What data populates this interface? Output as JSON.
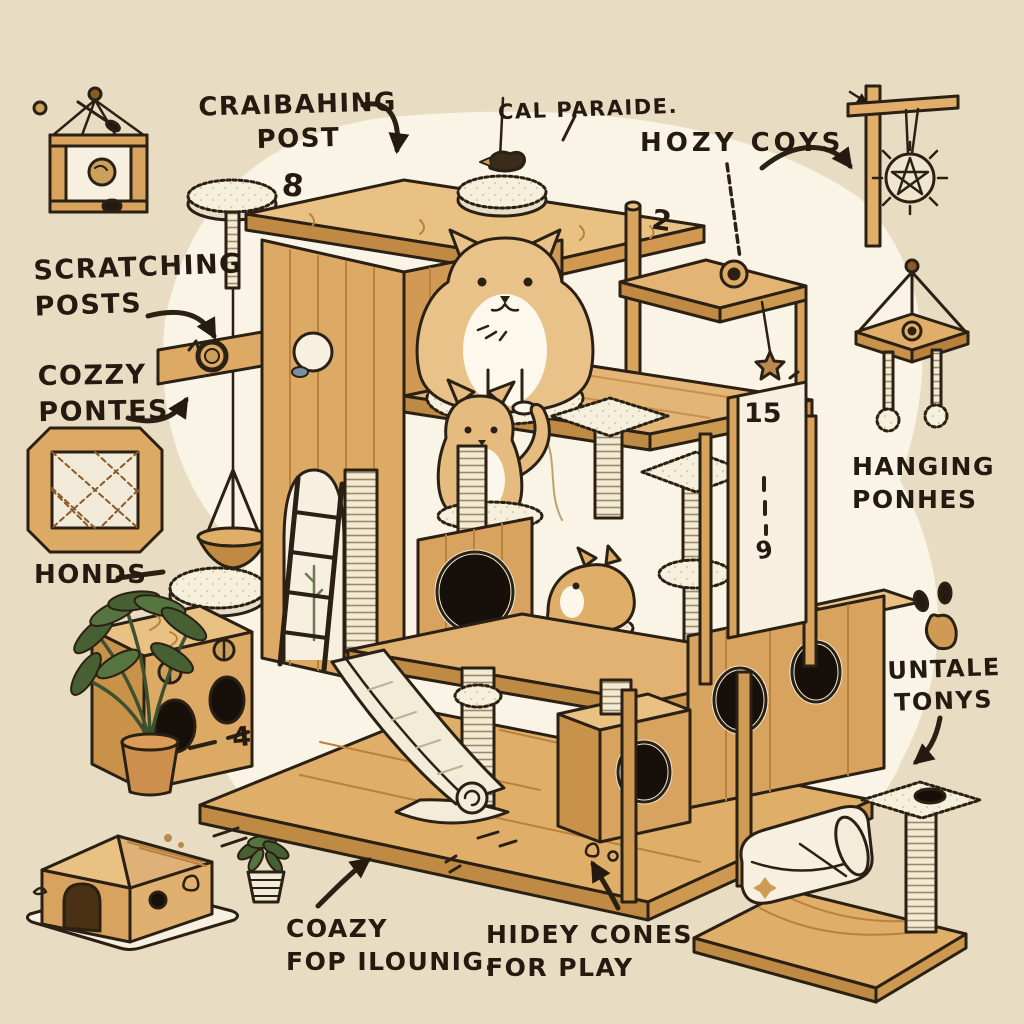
{
  "title_labels": {
    "craibahing_post": "CRAIBAHING\nPOST",
    "cal_paraide": "CAL PARAIDE.",
    "hozy_coys": "HOZY COYS",
    "scratching_posts": "SCRATCHING\nPOSTS",
    "cozzy_pontes": "COZZY\nPONTES",
    "honds": "HONDS",
    "hanging_ponhes": "HANGING\nPONHES",
    "untale_tonys": "UNTALE\nTONYS",
    "coazy_fop_ilounig": "COAZY\nFOP ILOUNIG.",
    "hidey_cones_for_play": "HIDEY CONES\nFOR PLAY"
  },
  "numbers": {
    "n8": "8",
    "n2": "2",
    "n15": "15",
    "n9": "9",
    "n4": "4"
  },
  "figures": [
    "hanging-box-toy",
    "mini-scratching-post",
    "hanging-ball-post",
    "hanging-platform-toy",
    "lattice-box",
    "hanging-basket",
    "floor-cushion",
    "toy-box-with-holes",
    "potted-plant",
    "cat-house",
    "small-plant",
    "mini-cat-tree",
    "cat-bed",
    "paw-print",
    "main-cat-tree",
    "cat-top",
    "cat-middle",
    "cat-small",
    "slide-ramp",
    "ladder",
    "arch-doorway"
  ],
  "colors": {
    "background": "#e8dcc2",
    "blob": "#faf4e6",
    "wood": "#dcaa64",
    "wood_light": "#e8c183",
    "wood_dark": "#bf8a43",
    "outline": "#2b2014",
    "hole": "#17100a",
    "sisal": "#f2ead4",
    "fluff": "#f5efdc",
    "ink": "#241a10",
    "plant_green": "#465f33",
    "cream": "#f7f0e1",
    "cat_fur": "#e9c28a"
  }
}
